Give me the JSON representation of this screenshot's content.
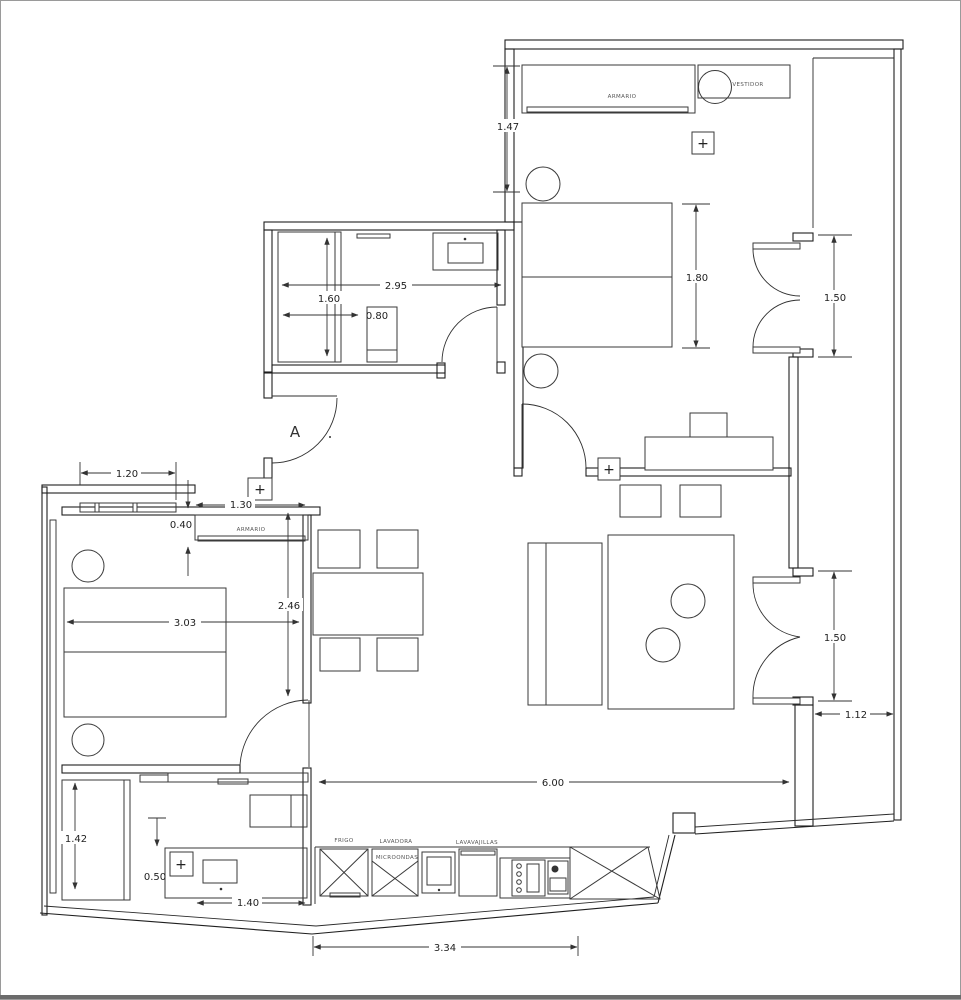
{
  "drawing": {
    "type": "apartment-floor-plan",
    "entrance_door_label": "A",
    "switch_symbol": "+",
    "labels": {
      "armario_hall": "ARMARIO",
      "vestidor": "VESTIDOR",
      "armario_bedroom": "ARMARIO",
      "frigo": "FRIGO",
      "lavadora": "LAVADORA",
      "microondas": "MICROONDAS",
      "lavavajillas": "LAVAVAJILLAS"
    },
    "dimensions": {
      "hall_depth": "1.47",
      "bath1_width": "2.95",
      "bath1_depth": "1.60",
      "shower1_width": "0.80",
      "bed1_length": "1.80",
      "window_top_right": "1.50",
      "window_bottom_right": "1.50",
      "bedroom2_window": "1.20",
      "wardrobe_width": "1.30",
      "wardrobe_depth": "0.40",
      "bedroom2_depth": "2.46",
      "bedroom2_width": "3.03",
      "living_width": "6.00",
      "balcony_width": "1.12",
      "bath2_depth": "1.42",
      "vanity_depth": "0.50",
      "vanity_width": "1.40",
      "kitchen_width": "3.34"
    }
  }
}
